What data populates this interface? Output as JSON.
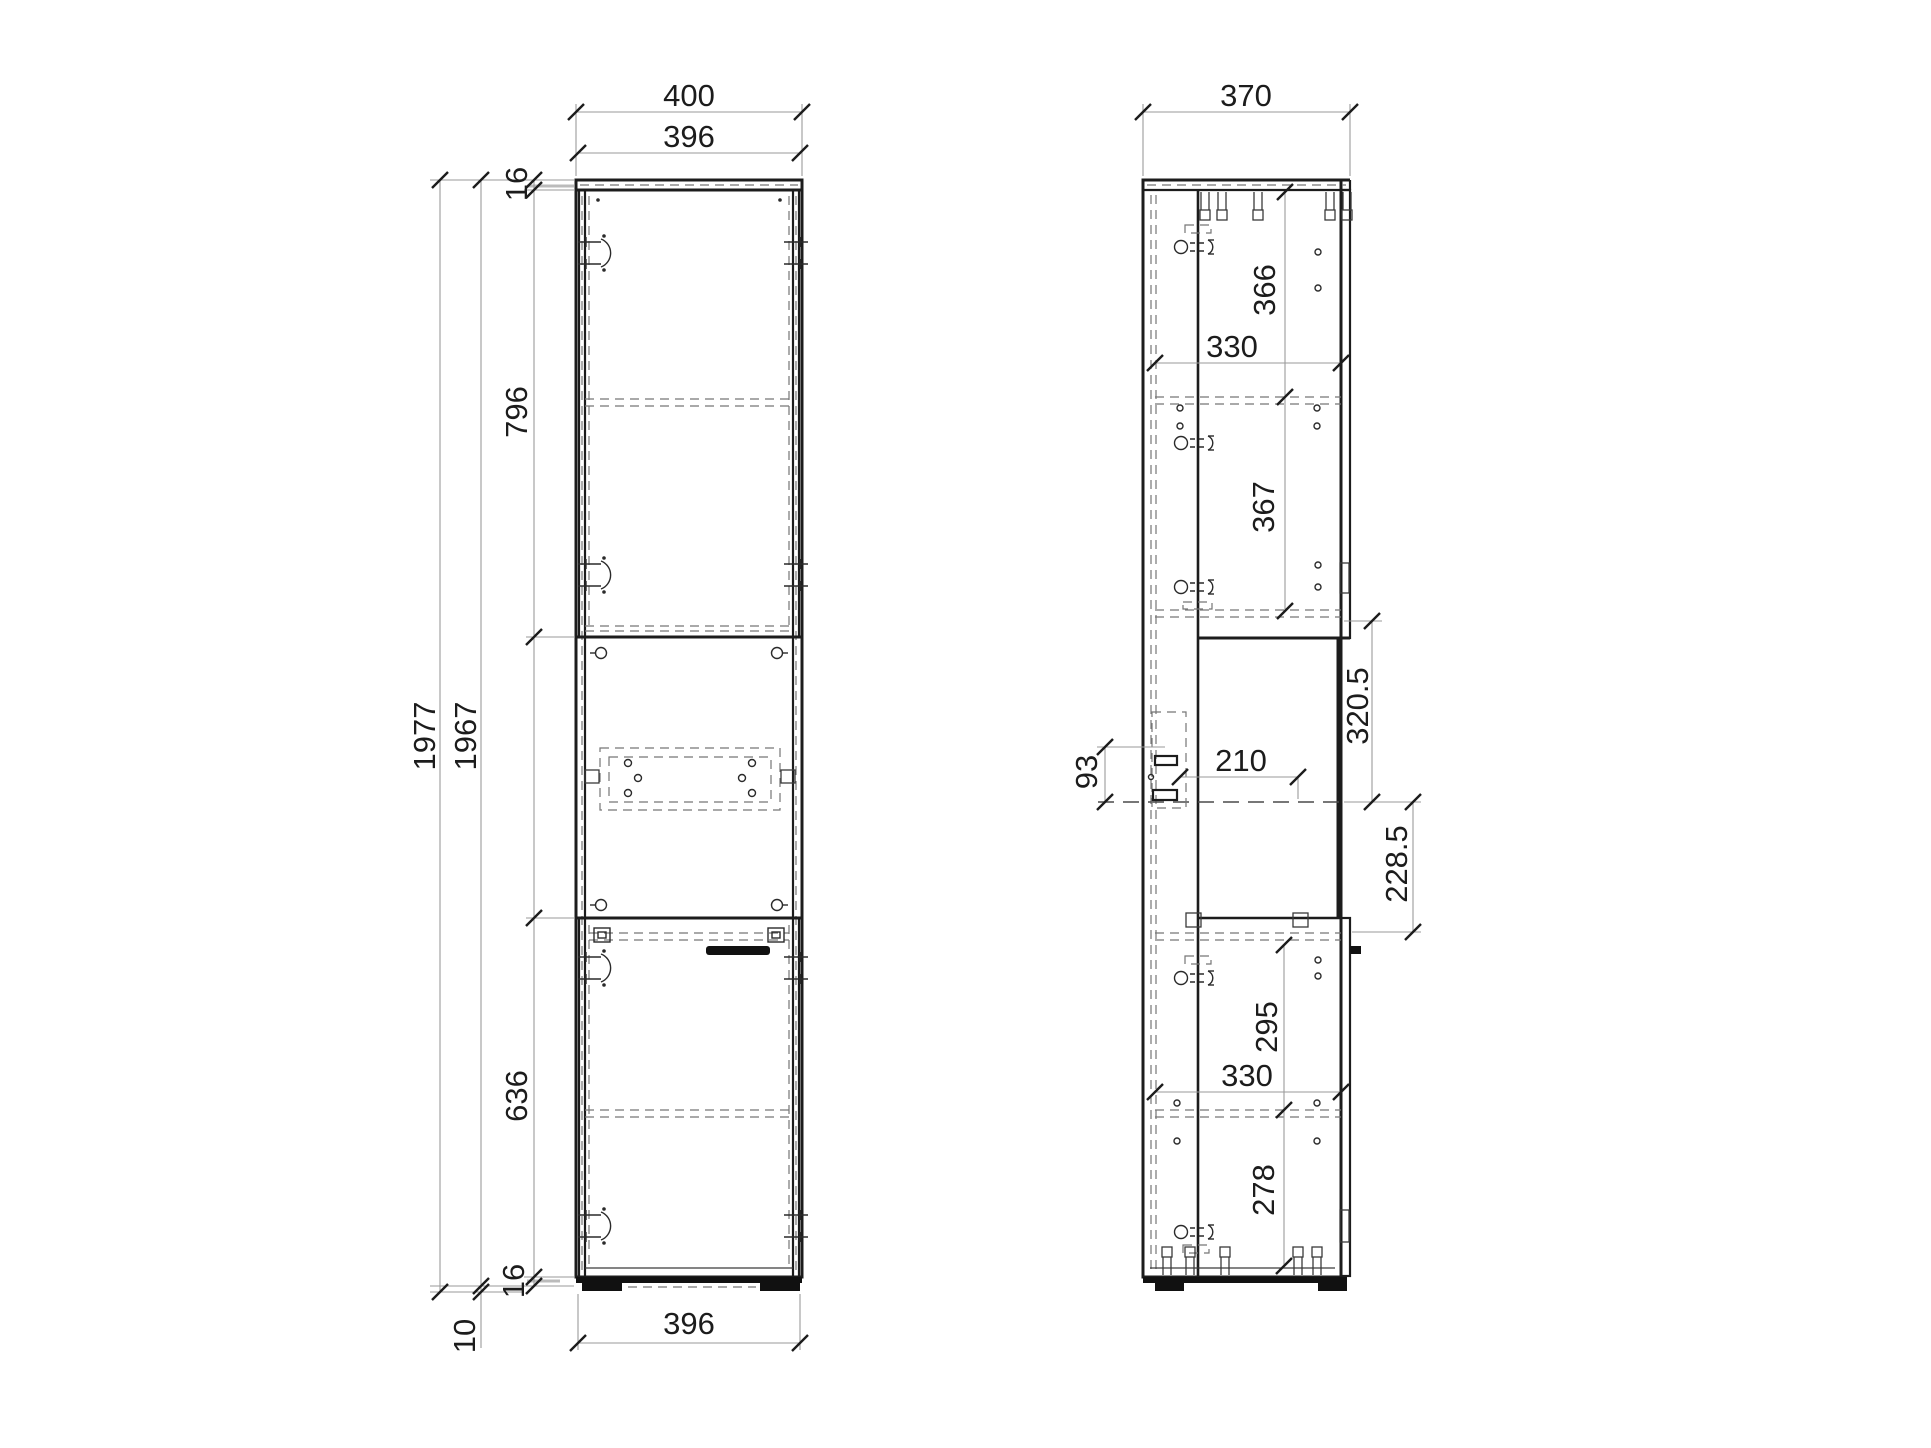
{
  "drawing": {
    "front": {
      "width_overall": "400",
      "width_top": "396",
      "height_overall": "1977",
      "height_carcass": "1967",
      "top_panel_thickness": "16",
      "top_door_height": "796",
      "bottom_door_height": "636",
      "bottom_panel_thickness": "16",
      "feet_height": "10",
      "width_bottom": "396"
    },
    "side": {
      "depth_overall": "370",
      "top_compartment": "366",
      "interior_depth_top": "330",
      "middle_compartment": "367",
      "front_gap_upper": "320.5",
      "front_gap_lower": "228.5",
      "slide_offset": "93",
      "slide_depth": "210",
      "bottom_compartment_upper": "295",
      "interior_depth_bottom": "330",
      "bottom_compartment_lower": "278"
    },
    "colors": {
      "background": "#ffffff",
      "outline": "#1c1c1c",
      "dimension_line": "#9a9a9a",
      "hidden_line": "#767676"
    }
  }
}
